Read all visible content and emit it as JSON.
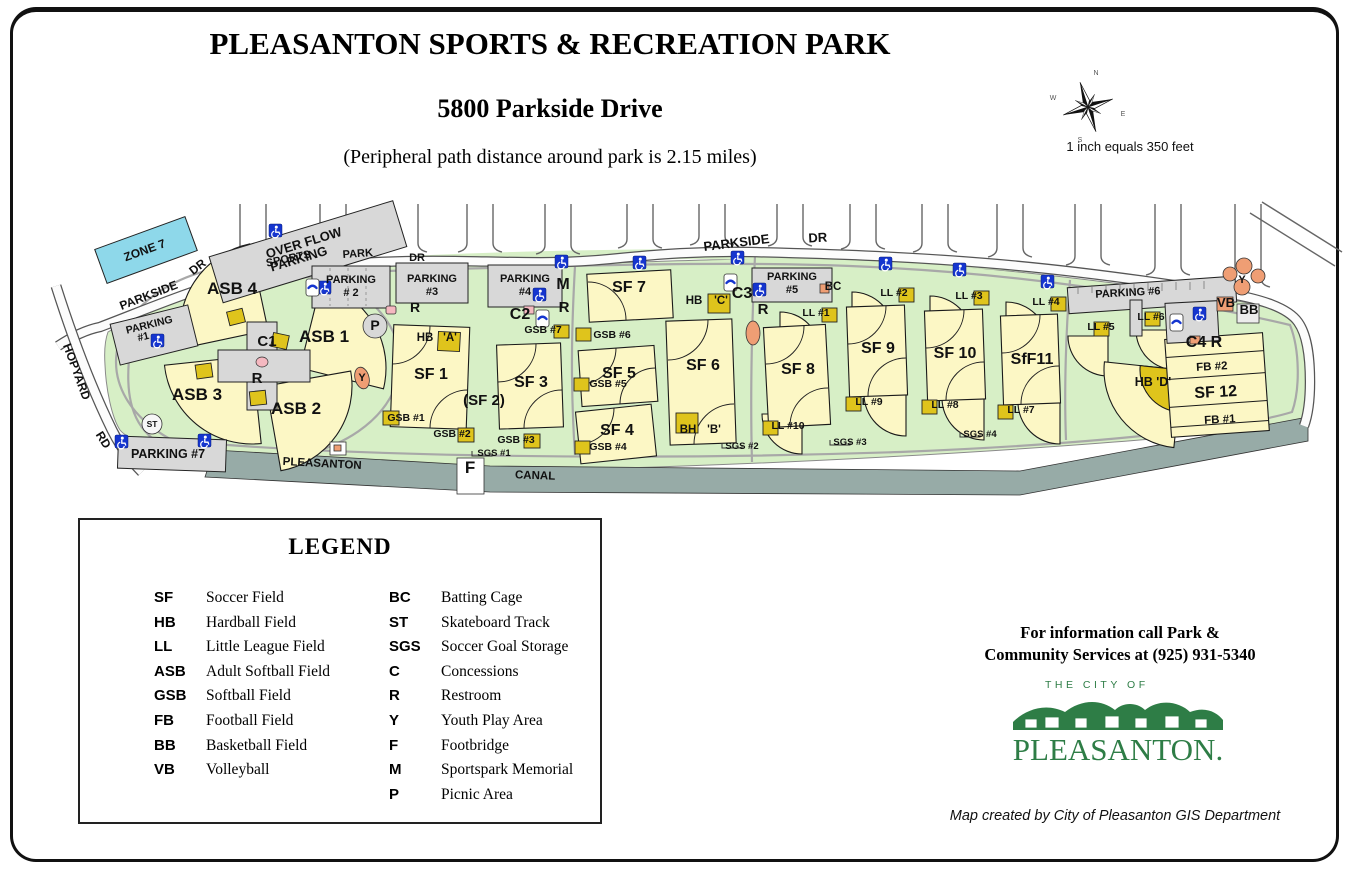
{
  "header": {
    "title": "PLEASANTON SPORTS & RECREATION PARK",
    "subtitle": "5800 Parkside Drive",
    "note": "(Peripheral path distance around park is 2.15 miles)",
    "scale_text": "1 inch equals 350 feet"
  },
  "compass": {
    "n": "N",
    "e": "E",
    "s": "S",
    "w": "W"
  },
  "colors": {
    "park_green": "#d7efc6",
    "field_yellow": "#fcf7c5",
    "dugout_gold": "#dfc41c",
    "parking_gray": "#d8d8d8",
    "canal_gray": "#97aba7",
    "accessible_blue": "#1535cf",
    "zone_blue": "#8ed8ea",
    "logo_green": "#2e7d46",
    "structure_salmon": "#ef9e74"
  },
  "map": {
    "labels": [
      {
        "t": "ZONE 7",
        "x": 146,
        "y": 254,
        "s": 12,
        "r": -20
      },
      {
        "t": "OVER FLOW",
        "x": 305,
        "y": 247,
        "s": 13,
        "r": -17
      },
      {
        "t": "PARKING",
        "x": 300,
        "y": 263,
        "s": 13,
        "r": -17
      },
      {
        "t": "PARKSIDE",
        "x": 150,
        "y": 299,
        "s": 12,
        "r": -21
      },
      {
        "t": "DR",
        "x": 200,
        "y": 270,
        "s": 12,
        "r": -38
      },
      {
        "t": "HOPYARD",
        "x": 73,
        "y": 373,
        "s": 12,
        "r": 70
      },
      {
        "t": "RD",
        "x": 100,
        "y": 442,
        "s": 12,
        "r": 58
      },
      {
        "t": "SPORTS",
        "x": 289,
        "y": 262,
        "s": 11,
        "r": -12
      },
      {
        "t": "PARK",
        "x": 358,
        "y": 257,
        "s": 11,
        "r": -4
      },
      {
        "t": "DR",
        "x": 417,
        "y": 261,
        "s": 11
      },
      {
        "t": "PARKSIDE",
        "x": 737,
        "y": 247,
        "s": 13,
        "r": -7
      },
      {
        "t": "DR",
        "x": 818,
        "y": 242,
        "s": 13,
        "r": -3
      },
      {
        "t": "PARKING",
        "x": 150,
        "y": 328,
        "s": 10.5,
        "r": -14
      },
      {
        "t": "#1",
        "x": 144,
        "y": 340,
        "s": 10.5,
        "r": -14
      },
      {
        "t": "PARKING",
        "x": 351,
        "y": 283,
        "s": 11
      },
      {
        "t": "# 2",
        "x": 351,
        "y": 296,
        "s": 11
      },
      {
        "t": "PARKING",
        "x": 432,
        "y": 282,
        "s": 11
      },
      {
        "t": "#3",
        "x": 432,
        "y": 295,
        "s": 11
      },
      {
        "t": "PARKING",
        "x": 525,
        "y": 282,
        "s": 11
      },
      {
        "t": "#4",
        "x": 525,
        "y": 295,
        "s": 11
      },
      {
        "t": "PARKING",
        "x": 792,
        "y": 280,
        "s": 11
      },
      {
        "t": "#5",
        "x": 792,
        "y": 293,
        "s": 11
      },
      {
        "t": "BC",
        "x": 833,
        "y": 290,
        "s": 11.5
      },
      {
        "t": "PARKING #6",
        "x": 1128,
        "y": 296,
        "s": 11,
        "r": -3
      },
      {
        "t": "PARKING #7",
        "x": 168,
        "y": 458,
        "s": 12.5
      },
      {
        "t": "PLEASANTON",
        "x": 322,
        "y": 467,
        "s": 11.5,
        "r": 3
      },
      {
        "t": "F",
        "x": 470,
        "y": 473,
        "s": 17
      },
      {
        "t": "CANAL",
        "x": 535,
        "y": 479,
        "s": 11.5,
        "r": 2
      },
      {
        "t": "M",
        "x": 563,
        "y": 289,
        "s": 16
      },
      {
        "t": "C2",
        "x": 520,
        "y": 319,
        "s": 16
      },
      {
        "t": "R",
        "x": 564,
        "y": 312,
        "s": 15
      },
      {
        "t": "C3",
        "x": 742,
        "y": 298,
        "s": 16
      },
      {
        "t": "R",
        "x": 763,
        "y": 314,
        "s": 15
      },
      {
        "t": "C1",
        "x": 267,
        "y": 346,
        "s": 15
      },
      {
        "t": "R",
        "x": 257,
        "y": 383,
        "s": 15
      },
      {
        "t": "P",
        "x": 375,
        "y": 330,
        "s": 14
      },
      {
        "t": "R",
        "x": 415,
        "y": 312,
        "s": 14
      },
      {
        "t": "ST",
        "x": 152,
        "y": 427,
        "s": 8.5
      },
      {
        "t": "Y",
        "x": 362,
        "y": 381,
        "s": 11
      },
      {
        "t": "Y",
        "x": 1242,
        "y": 283,
        "s": 11
      },
      {
        "t": "C4 R",
        "x": 1204,
        "y": 347,
        "s": 16
      },
      {
        "t": "VB",
        "x": 1226,
        "y": 307,
        "s": 13
      },
      {
        "t": "BB",
        "x": 1249,
        "y": 314,
        "s": 13
      },
      {
        "t": "ASB 4",
        "x": 232,
        "y": 294,
        "s": 17
      },
      {
        "t": "ASB 1",
        "x": 324,
        "y": 342,
        "s": 17
      },
      {
        "t": "ASB 3",
        "x": 197,
        "y": 400,
        "s": 17
      },
      {
        "t": "ASB 2",
        "x": 296,
        "y": 414,
        "s": 17
      },
      {
        "t": "SF 1",
        "x": 431,
        "y": 379,
        "s": 16
      },
      {
        "t": "(SF 2)",
        "x": 484,
        "y": 405,
        "s": 15
      },
      {
        "t": "SF 3",
        "x": 531,
        "y": 387,
        "s": 16
      },
      {
        "t": "SF 4",
        "x": 617,
        "y": 435,
        "s": 16
      },
      {
        "t": "SF 5",
        "x": 619,
        "y": 378,
        "s": 16
      },
      {
        "t": "SF 6",
        "x": 703,
        "y": 370,
        "s": 16
      },
      {
        "t": "SF 7",
        "x": 629,
        "y": 292,
        "s": 16
      },
      {
        "t": "SF 8",
        "x": 798,
        "y": 374,
        "s": 16
      },
      {
        "t": "SF 9",
        "x": 878,
        "y": 353,
        "s": 16
      },
      {
        "t": "SF 10",
        "x": 955,
        "y": 358,
        "s": 16
      },
      {
        "t": "SfF11",
        "x": 1032,
        "y": 364,
        "s": 16
      },
      {
        "t": "SF 12",
        "x": 1216,
        "y": 397,
        "s": 16,
        "r": -3
      },
      {
        "t": "FB #2",
        "x": 1212,
        "y": 370,
        "s": 11.5,
        "r": -3
      },
      {
        "t": "FB #1",
        "x": 1220,
        "y": 423,
        "s": 11.5,
        "r": -3
      },
      {
        "t": "HB",
        "x": 425,
        "y": 341,
        "s": 11.5
      },
      {
        "t": "'A'",
        "x": 450,
        "y": 341,
        "s": 11.5
      },
      {
        "t": "HB",
        "x": 694,
        "y": 304,
        "s": 11.5
      },
      {
        "t": "'C'",
        "x": 721,
        "y": 304,
        "s": 11.5
      },
      {
        "t": "BH",
        "x": 688,
        "y": 433,
        "s": 11.5
      },
      {
        "t": "'B'",
        "x": 714,
        "y": 433,
        "s": 11.5
      },
      {
        "t": "HB 'D'",
        "x": 1153,
        "y": 386,
        "s": 12.5
      },
      {
        "t": "GSB #7",
        "x": 543,
        "y": 333,
        "s": 10.5
      },
      {
        "t": "GSB #6",
        "x": 612,
        "y": 338,
        "s": 10.5
      },
      {
        "t": "GSB #5",
        "x": 608,
        "y": 387,
        "s": 10.5
      },
      {
        "t": "GSB #4",
        "x": 608,
        "y": 450,
        "s": 10.5
      },
      {
        "t": "GSB #1",
        "x": 406,
        "y": 421,
        "s": 10.5
      },
      {
        "t": "GSB #2",
        "x": 452,
        "y": 437,
        "s": 10.5
      },
      {
        "t": "GSB #3",
        "x": 516,
        "y": 443,
        "s": 10.5
      },
      {
        "t": "SGS #1",
        "x": 494,
        "y": 456,
        "s": 9.5
      },
      {
        "t": "SGS #2",
        "x": 742,
        "y": 449,
        "s": 9.5
      },
      {
        "t": "SGS #3",
        "x": 850,
        "y": 445,
        "s": 9.5
      },
      {
        "t": "SGS #4",
        "x": 980,
        "y": 437,
        "s": 9.5
      },
      {
        "t": "LL #1",
        "x": 816,
        "y": 316,
        "s": 10.5
      },
      {
        "t": "LL #2",
        "x": 894,
        "y": 296,
        "s": 10.5
      },
      {
        "t": "LL #3",
        "x": 969,
        "y": 299,
        "s": 10.5
      },
      {
        "t": "LL #4",
        "x": 1046,
        "y": 305,
        "s": 10.5
      },
      {
        "t": "LL #5",
        "x": 1101,
        "y": 330,
        "s": 10.5
      },
      {
        "t": "LL #6",
        "x": 1151,
        "y": 320,
        "s": 10.5
      },
      {
        "t": "LL #7",
        "x": 1021,
        "y": 413,
        "s": 10.5
      },
      {
        "t": "LL #8",
        "x": 945,
        "y": 408,
        "s": 10.5
      },
      {
        "t": "LL #9",
        "x": 869,
        "y": 405,
        "s": 10.5
      },
      {
        "t": "LL #10",
        "x": 788,
        "y": 429,
        "s": 10.5
      }
    ]
  },
  "legend": {
    "title": "LEGEND",
    "columns": [
      [
        {
          "abbr": "SF",
          "desc": "Soccer Field"
        },
        {
          "abbr": "HB",
          "desc": "Hardball Field"
        },
        {
          "abbr": "LL",
          "desc": "Little League Field"
        },
        {
          "abbr": "ASB",
          "desc": "Adult Softball Field"
        },
        {
          "abbr": "GSB",
          "desc": "Softball Field"
        },
        {
          "abbr": "FB",
          "desc": "Football Field"
        },
        {
          "abbr": "BB",
          "desc": "Basketball Field"
        },
        {
          "abbr": "VB",
          "desc": "Volleyball"
        }
      ],
      [
        {
          "abbr": "BC",
          "desc": "Batting Cage"
        },
        {
          "abbr": "ST",
          "desc": "Skateboard Track"
        },
        {
          "abbr": "SGS",
          "desc": "Soccer Goal Storage"
        },
        {
          "abbr": "C",
          "desc": "Concessions"
        },
        {
          "abbr": "R",
          "desc": "Restroom"
        },
        {
          "abbr": "Y",
          "desc": "Youth Play Area"
        },
        {
          "abbr": "F",
          "desc": "Footbridge"
        },
        {
          "abbr": "M",
          "desc": "Sportspark Memorial"
        },
        {
          "abbr": "P",
          "desc": "Picnic Area"
        }
      ]
    ]
  },
  "footer": {
    "info_line1": "For information call Park &",
    "info_line2": "Community Services at (925) 931-5340",
    "logo_top": "THE CITY OF",
    "logo_name": "PLEASANTON.",
    "credit": "Map created by City of Pleasanton GIS Department"
  }
}
